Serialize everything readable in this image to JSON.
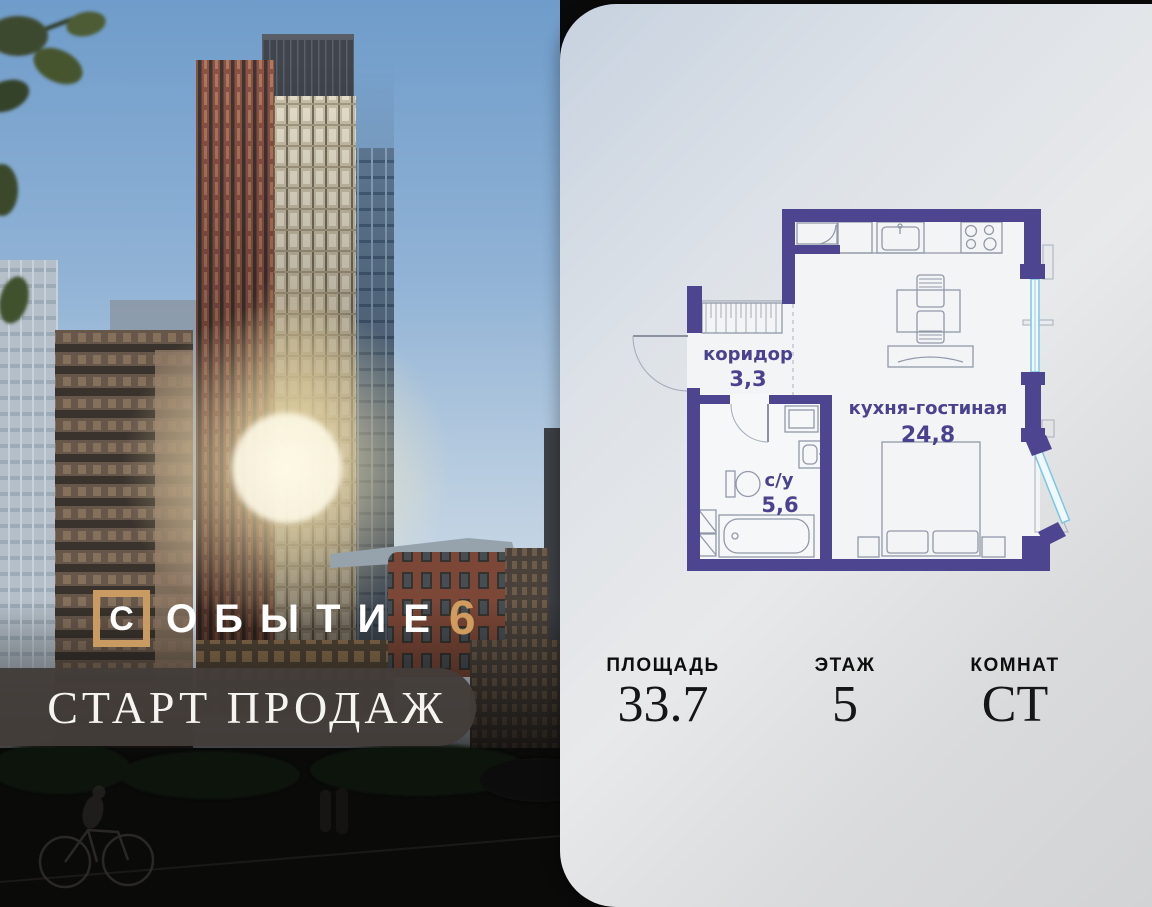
{
  "logo": {
    "word_first_letter": "С",
    "word_rest": "ОБЫТИЕ",
    "number": "6"
  },
  "banner": {
    "label": "СТАРТ ПРОДАЖ"
  },
  "floor_plan": {
    "rooms": [
      {
        "name": "коридор",
        "area": "3,3"
      },
      {
        "name": "с/у",
        "area": "5,6"
      },
      {
        "name": "кухня-гостиная",
        "area": "24,8"
      }
    ]
  },
  "stats": {
    "items": [
      {
        "label": "ПЛОЩАДЬ",
        "value": "33.7"
      },
      {
        "label": "ЭТАЖ",
        "value": "5"
      },
      {
        "label": "КОМНАТ",
        "value": "СТ"
      }
    ]
  },
  "colors": {
    "wall": "#4e4591",
    "plan_text": "#4a428f",
    "window": "#7cc6e4",
    "gold": "#c99a62",
    "banner_bg": "#433d3a"
  }
}
